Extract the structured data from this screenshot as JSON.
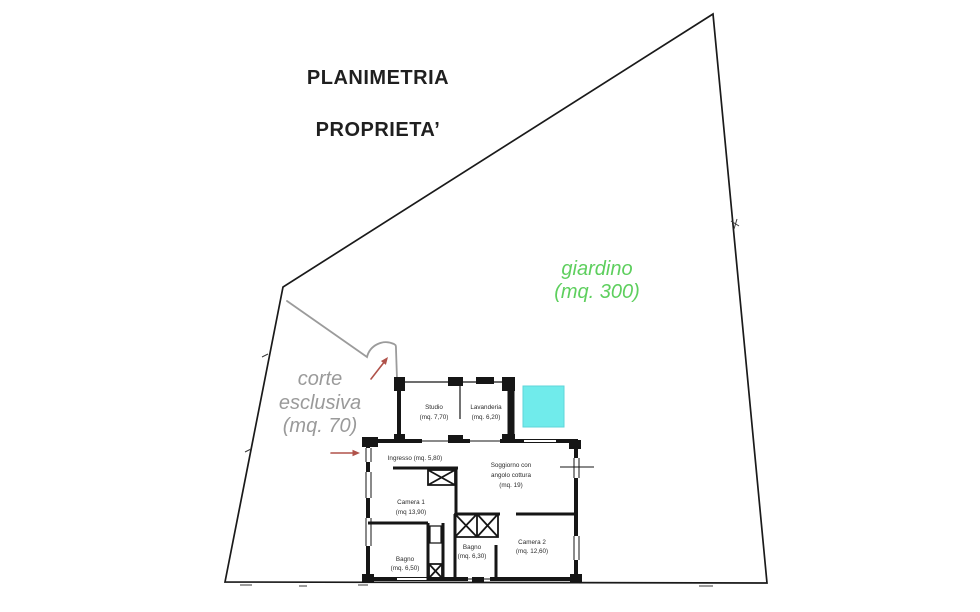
{
  "title": {
    "line1": "PLANIMETRIA",
    "line2": "PROPRIETA’"
  },
  "garden": {
    "name": "giardino",
    "area": "(mq. 300)"
  },
  "court": {
    "line1": "corte",
    "line2": "esclusiva",
    "area": "(mq. 70)"
  },
  "plan": {
    "rooms": {
      "studio": {
        "name": "Studio",
        "area": "(mq. 7,70)"
      },
      "lavanderia": {
        "name": "Lavanderia",
        "area": "(mq. 6,20)"
      },
      "ingresso": {
        "name": "Ingresso (mq. 5,80)"
      },
      "soggiorno": {
        "line1": "Soggiorno con",
        "line2": "angolo cottura",
        "area": "(mq. 19)"
      },
      "camera1": {
        "name": "Camera 1",
        "area": "(mq 13,90)"
      },
      "bagno1": {
        "name": "Bagno",
        "area": "(mq. 6,50)"
      },
      "bagno2": {
        "name": "Bagno",
        "area": "(mq. 6,30)"
      },
      "camera2": {
        "name": "Camera 2",
        "area": "(mq. 12,60)"
      }
    }
  },
  "colors": {
    "garden": "#5ecf5e",
    "court": "#9a9a9a",
    "cyan_square": "#70ebeb",
    "arrow": "#b0524a",
    "path": "#9b9b9b",
    "ink": "#1a1a1a"
  }
}
